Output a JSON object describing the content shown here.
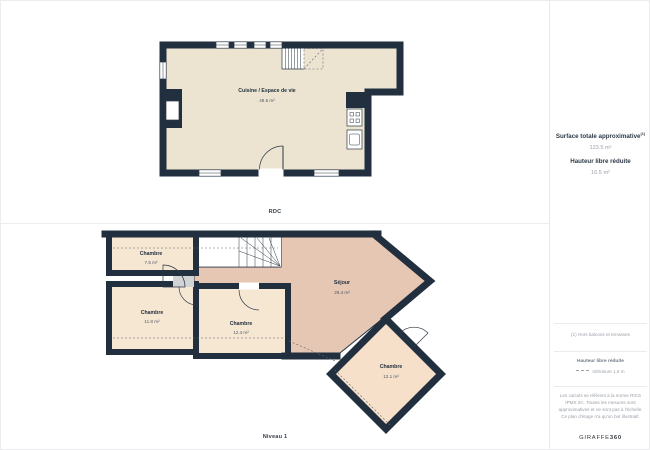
{
  "floors": {
    "rdc": {
      "caption": "RDC",
      "rooms": {
        "cuisine": {
          "name": "Cuisine / Espace de vie",
          "area": "49.5 m²"
        }
      }
    },
    "niveau1": {
      "caption": "Niveau 1",
      "rooms": {
        "chambre1": {
          "name": "Chambre",
          "area": "7.5 m²"
        },
        "chambre2": {
          "name": "Chambre",
          "area": "11.8 m²"
        },
        "chambre3": {
          "name": "Chambre",
          "area": "12.4 m²"
        },
        "sejour": {
          "name": "Séjour",
          "area": "29.4 m²"
        },
        "chambre4": {
          "name": "Chambre",
          "area": "12.1 m²"
        }
      }
    }
  },
  "panel": {
    "surface": {
      "label": "Surface totale approximative",
      "marker": "(1)",
      "value": "123.5 m²"
    },
    "hauteur": {
      "label": "Hauteur libre réduite",
      "value": "16.5 m²"
    },
    "footnote": "(1) Hors balcons et terrasses",
    "legend": {
      "title": "Hauteur libre réduite",
      "item": "Inférieure 1,5 m"
    },
    "disclaimer": "Les calculs se réfèrent à la norme RICS IPMS 3C. Toutes les mesures sont approximatives et ne sont pas à l'échelle. Ce plan d'étage n'a qu'un but illustratif.",
    "brand": {
      "name": "GIRAFFE",
      "suffix": "360"
    }
  },
  "colors": {
    "wall": "#212f3f",
    "floor_rdc": "#ece4d1",
    "floor_chambre": "#f6e7d3",
    "floor_sejour": "#e6c7b3",
    "floor_chambre_rotated": "#f7e0c9"
  }
}
